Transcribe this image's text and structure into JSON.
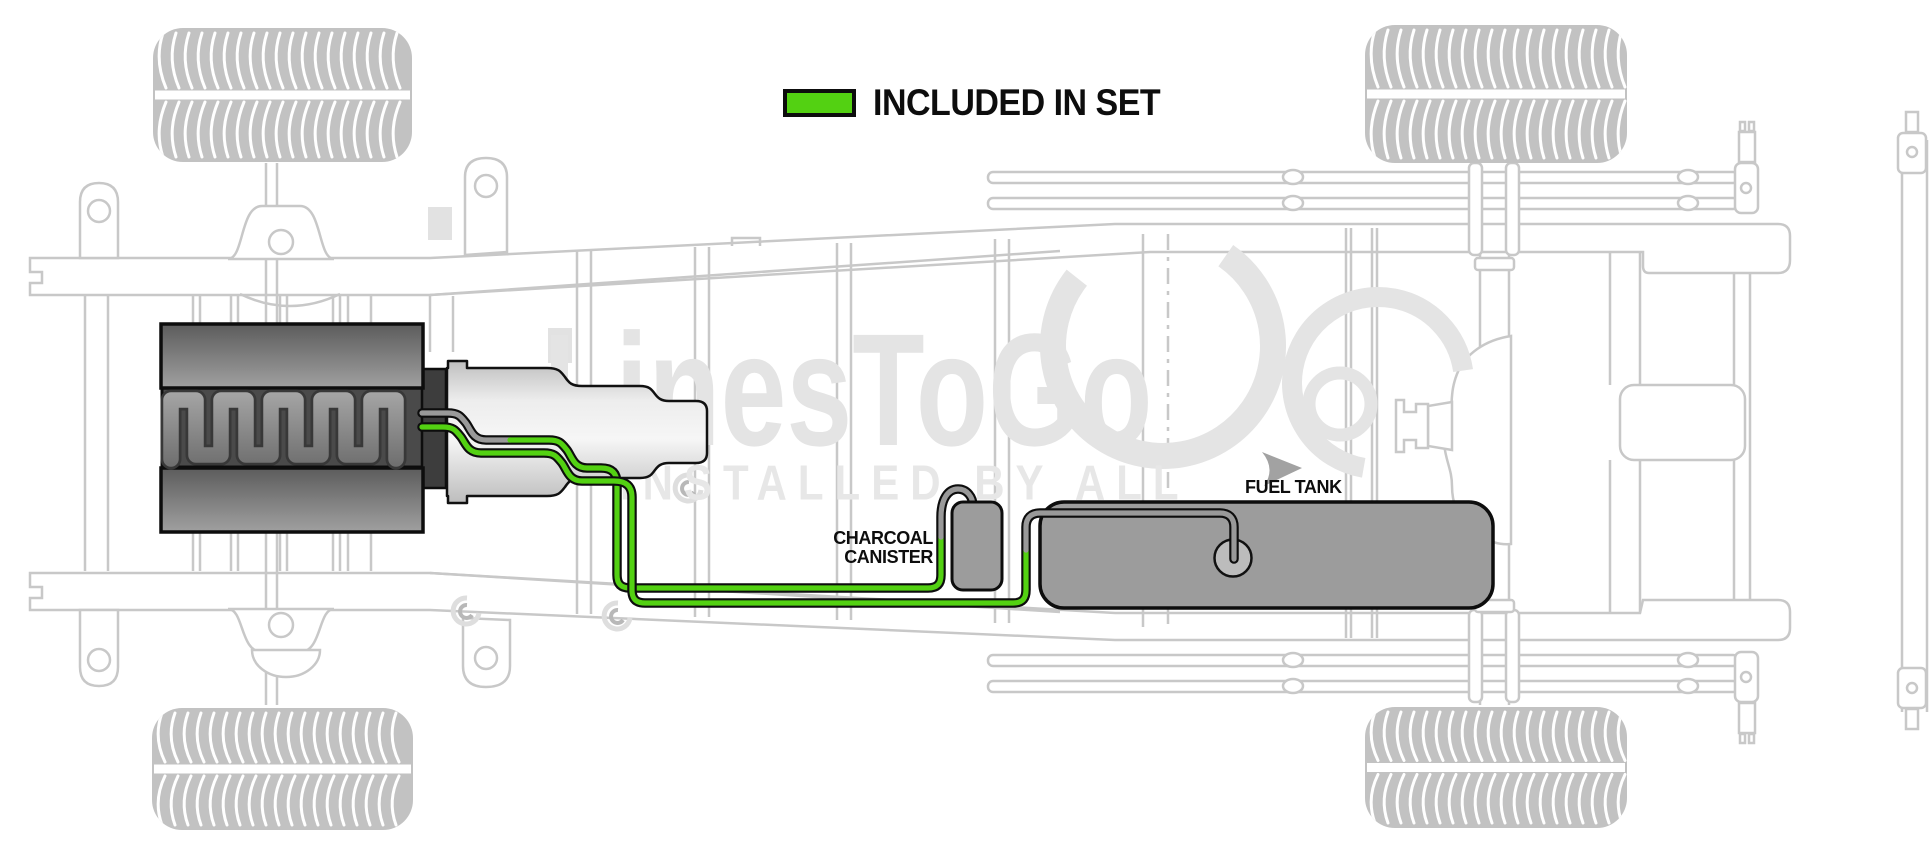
{
  "legend": {
    "label": "INCLUDED IN SET"
  },
  "labels": {
    "charcoal_canister_line1": "CHARCOAL",
    "charcoal_canister_line2": "CANISTER",
    "fuel_tank": "FUEL TANK"
  },
  "watermark": {
    "brand": "LinesToGo",
    "tagline": "INSTALLED BY ALL"
  },
  "colors": {
    "included_green": "#53d112",
    "line_gray": "#999999",
    "component_gray": "#9c9c9c",
    "outline_black": "#0d0d0d",
    "chassis_gray": "#c8c8c8"
  }
}
